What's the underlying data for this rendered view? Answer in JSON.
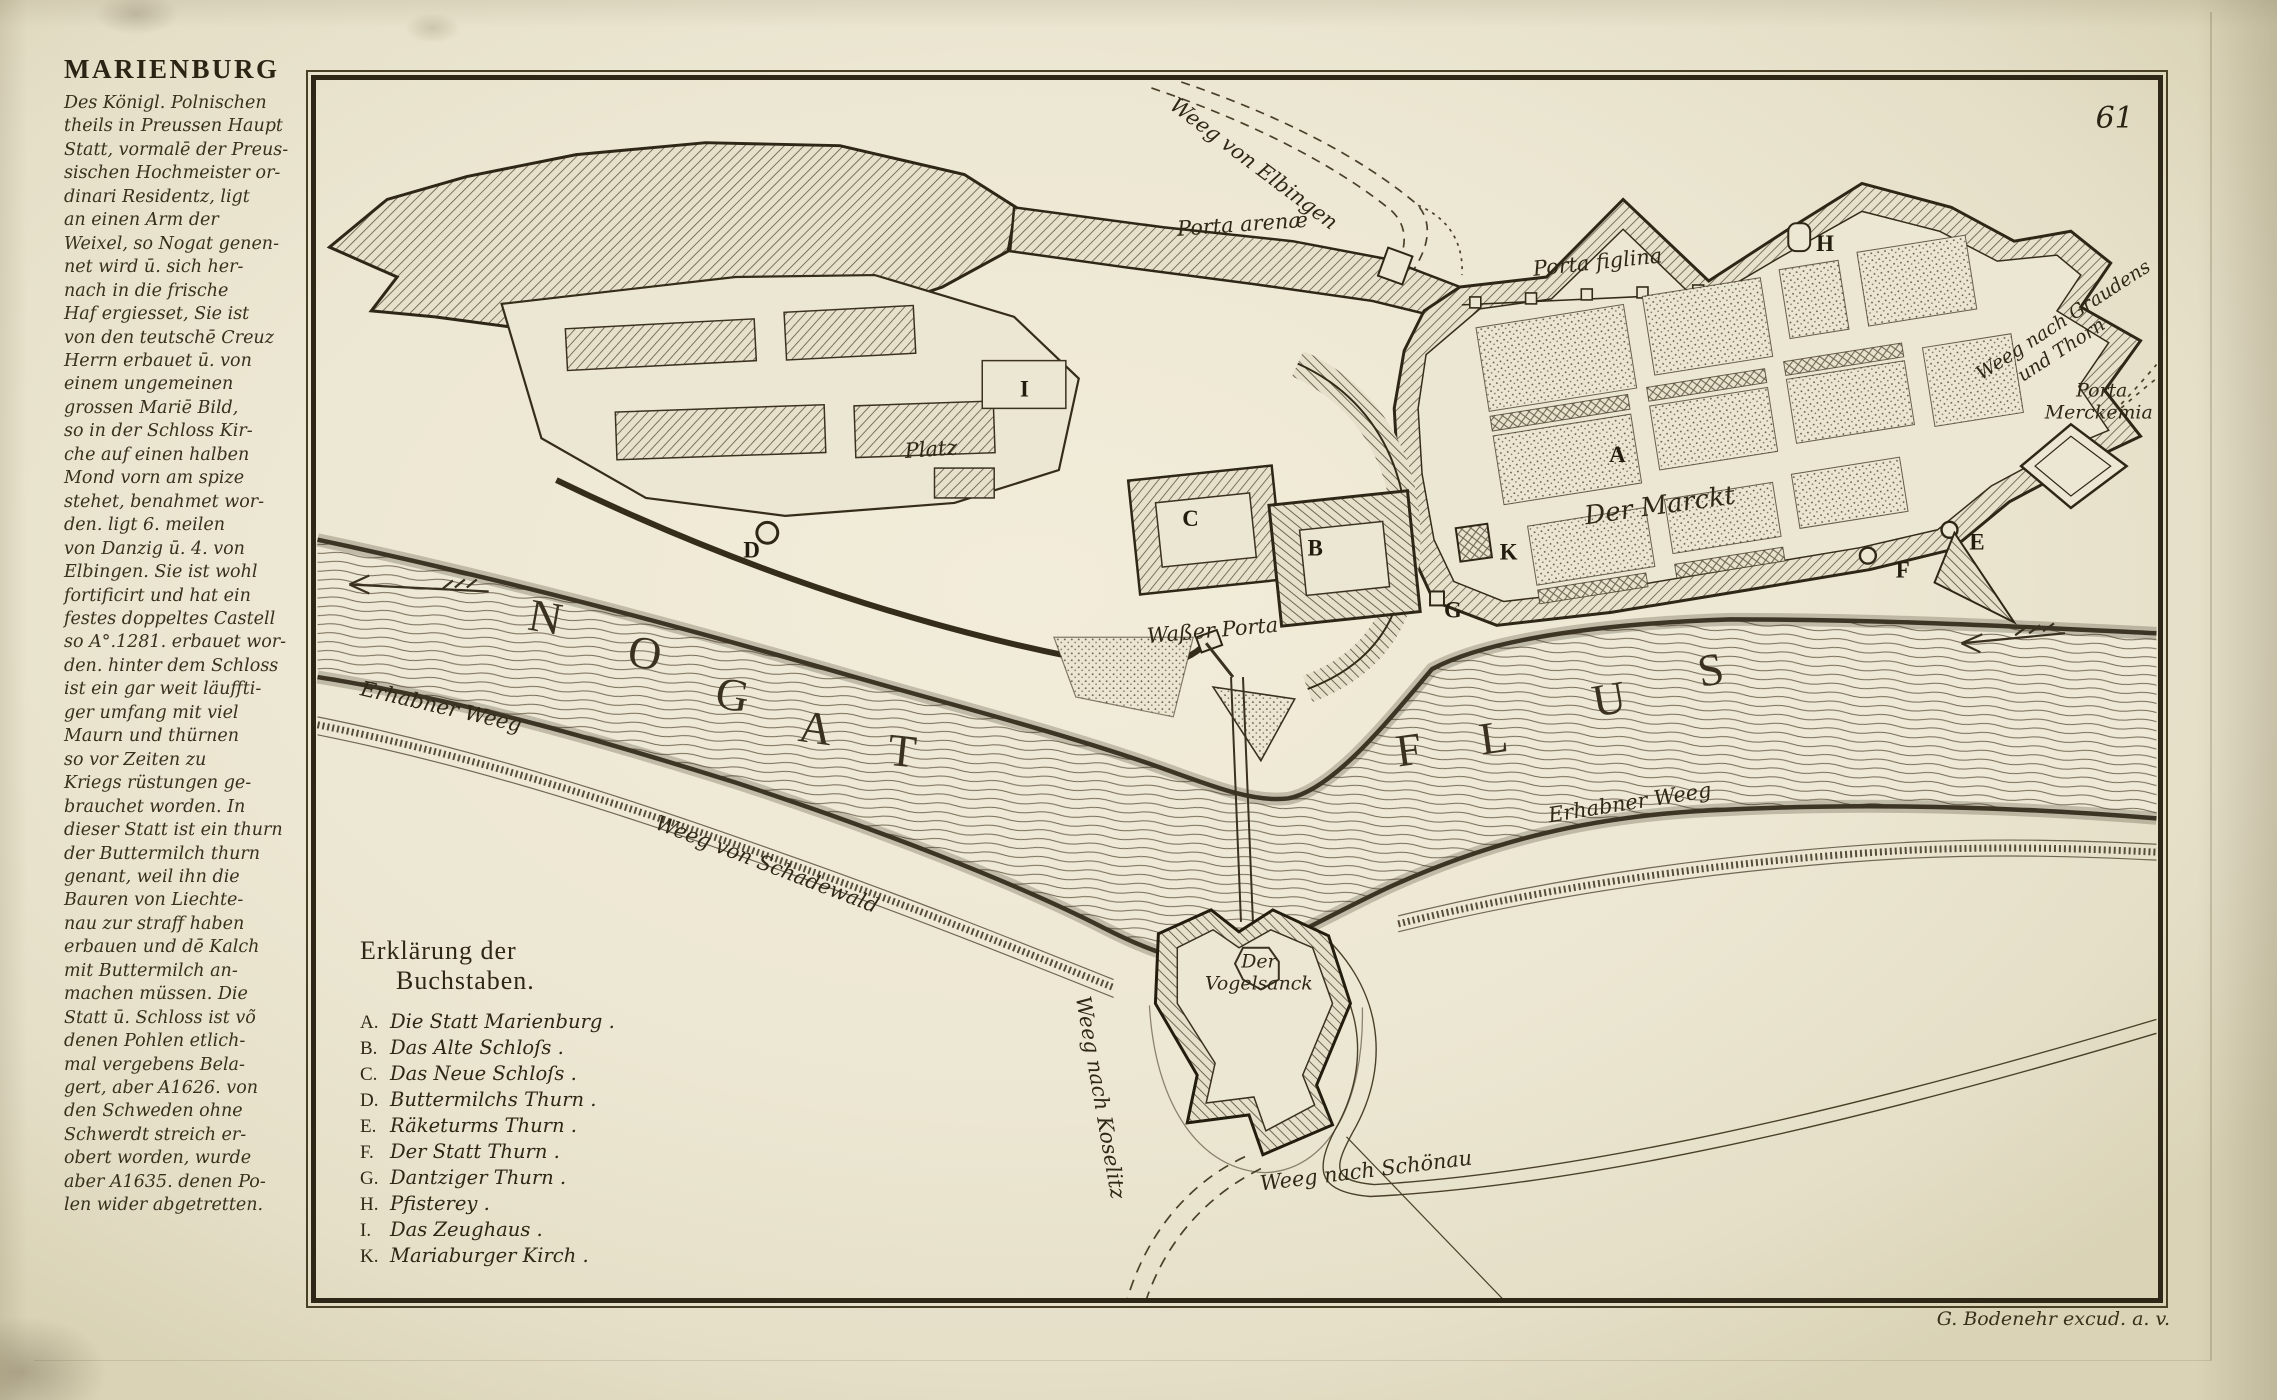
{
  "page": {
    "plate_number": "61",
    "imprint": "G. Bodenehr excud. a. v."
  },
  "sidebar": {
    "title": "MARIENBURG",
    "description": "Des Königl. Polnischen\ntheils in Preussen Haupt\nStatt, vormalē der Preus-\nsischen Hochmeister or-\ndinari Residentz, ligt\nan einen Arm der\nWeixel, so Nogat genen-\nnet wird ū. sich her-\nnach in die frische\nHaf ergiesset, Sie ist\nvon den teutschē Creuz\nHerrn erbauet ū. von\neinem ungemeinen\ngrossen Mariē Bild,\nso in der Schloss Kir-\nche auf einen halben\nMond vorn am spize\nstehet, benahmet wor-\nden. ligt 6. meilen\nvon Danzig ū. 4. von\nElbingen. Sie ist wohl\nfortificirt und hat ein\nfestes doppeltes Castell\nso A°.1281. erbauet wor-\nden. hinter dem Schloss\nist ein gar weit läuffti-\nger umfang mit viel\nMaurn und thürnen\nso vor Zeiten zu\nKriegs rüstungen ge-\nbrauchet worden. In\ndieser Statt ist ein thurn\nder Buttermilch thurn\ngenant, weil ihn die\nBauren von Liechte-\nnau zur straff haben\nerbauen und dē Kalch\nmit Buttermilch an-\nmachen müssen. Die\nStatt ū. Schloss ist võ\ndenen Pohlen etlich-\nmal vergebens Bela-\ngert, aber A1626. von\nden Schweden ohne\nSchwerdt streich er-\nobert worden, wurde\naber A1635. denen Po-\nlen wider abgetretten."
  },
  "legend": {
    "title_line1": "Erklärung der",
    "title_line2": "Buchstaben.",
    "items": [
      {
        "k": "A.",
        "t": "Die Statt Marienburg ."
      },
      {
        "k": "B.",
        "t": "Das Alte Schloſs ."
      },
      {
        "k": "C.",
        "t": "Das Neue Schloſs ."
      },
      {
        "k": "D.",
        "t": "Buttermilchs Thurn ."
      },
      {
        "k": "E.",
        "t": "Räketurms Thurn ."
      },
      {
        "k": "F.",
        "t": "Der Statt Thurn ."
      },
      {
        "k": "G.",
        "t": "Dantziger Thurn ."
      },
      {
        "k": "H.",
        "t": "Pfisterey ."
      },
      {
        "k": "I.",
        "t": "Das Zeughaus ."
      },
      {
        "k": "K.",
        "t": "Mariaburger Kirch ."
      }
    ]
  },
  "map": {
    "labels": {
      "weeg_von_elbingen": "Weeg von Elbingen",
      "porta_arenae": "Porta arenæ",
      "porta_figlina": "Porta figlina",
      "weeg_nach_graudens_1": "Weeg nach Graudens",
      "weeg_nach_graudens_2": "und Thorn",
      "porta_merckemia_1": "Porta",
      "porta_merckemia_2": "Merckemia",
      "platz": "Platz",
      "der_marckt": "Der Marckt",
      "wasser_porta": "Waßer Porta",
      "erhabner_weeg_left": "Erhabner Weeg",
      "erhabner_weeg_right": "Erhabner Weeg",
      "weeg_von_schadewald": "Weeg von Schadewald",
      "weeg_nach_schonau": "Weeg nach Schönau",
      "weeg_nach_koselitz": "Weeg nach Koselitz",
      "vogelsanck_1": "Der",
      "vogelsanck_2": "Vogelsanck"
    },
    "river_name": {
      "nogat": [
        "N",
        "O",
        "G",
        "A",
        "T"
      ],
      "flus": [
        "F",
        "L",
        "U",
        "S"
      ]
    },
    "markers": {
      "A": "A",
      "B": "B",
      "C": "C",
      "D": "D",
      "E": "E",
      "F": "F",
      "G": "G",
      "H": "H",
      "I": "I",
      "K": "K"
    }
  }
}
